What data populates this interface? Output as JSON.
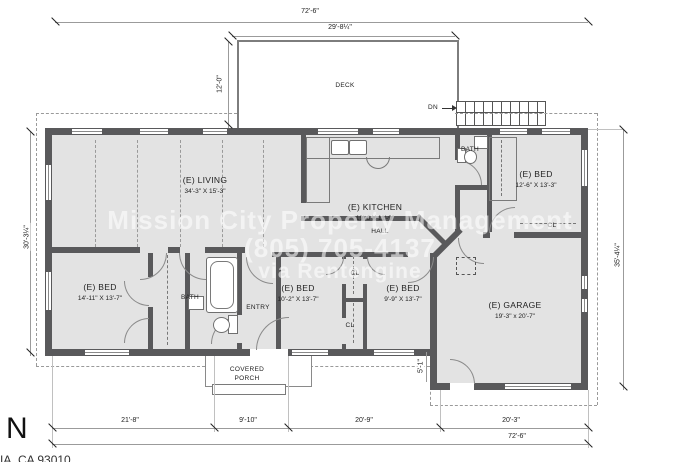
{
  "watermark": {
    "line1": "Mission City Property Management",
    "line2": "(805) 705-4137",
    "line3": "via Rentengine"
  },
  "compass_north": "N",
  "address_partial": "IA, CA 93010",
  "rooms": [
    {
      "id": "living",
      "name": "(E) LIVING",
      "size": "34'-3\" X 15'-3\""
    },
    {
      "id": "kitchen",
      "name": "(E) KITCHEN",
      "size": "19'-6 X 11'-9\""
    },
    {
      "id": "bed-ne",
      "name": "(E) BED",
      "size": "12'-6\" X 13'-3\""
    },
    {
      "id": "bed-sw",
      "name": "(E) BED",
      "size": "14'-11\" X 13'-7\""
    },
    {
      "id": "bed-s1",
      "name": "(E) BED",
      "size": "10'-2\" X 13'-7\""
    },
    {
      "id": "bed-s2",
      "name": "(E) BED",
      "size": "9'-9\" X 13'-7\""
    },
    {
      "id": "garage",
      "name": "(E) GARAGE",
      "size": "19'-3\" x 20'-7\""
    }
  ],
  "labels": {
    "deck": "DECK",
    "down": "DN",
    "hall": "HALL",
    "bath": "BATH",
    "entry": "ENTRY",
    "closet": "CL",
    "covered": "COVERED",
    "porch": "PORCH"
  },
  "dimensions": {
    "overall_width_top": "72'-6\"",
    "deck_width": "29'-8¼\"",
    "deck_depth": "12'-0\"",
    "left_depth": "30'-3¼\"",
    "right_depth": "35'-4¼\"",
    "garage_offset": "5'-1\"",
    "seg_bed_wing": "21'-8\"",
    "seg_porch": "9'-10\"",
    "seg_mid": "20'-9\"",
    "seg_garage": "20'-3\"",
    "overall_width_bottom": "72'-6\""
  }
}
